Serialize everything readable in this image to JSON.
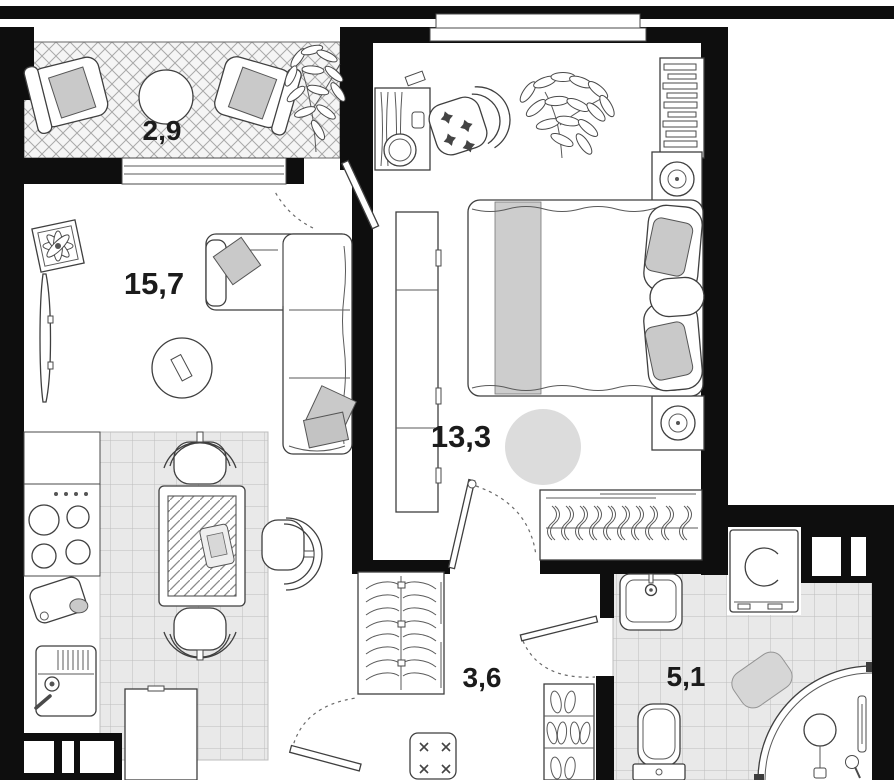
{
  "plan": {
    "title": "apartment-floor-plan",
    "rooms": [
      {
        "name": "balcony",
        "area": "2,9"
      },
      {
        "name": "living-room",
        "area": "15,7"
      },
      {
        "name": "bedroom",
        "area": "13,3"
      },
      {
        "name": "hallway",
        "area": "3,6"
      },
      {
        "name": "bathroom",
        "area": "5,1"
      }
    ],
    "colors": {
      "wall": "#0e0e0e",
      "floor": "#ffffff",
      "tile": "#e9e9e9",
      "tile_line": "#bdbdbd",
      "balcony_hatch": "#f5f5f5",
      "furniture_outline": "#3f3f3f",
      "soft_gray": "#c9c9c9",
      "rug_gray": "#dcdcdc",
      "label": "#1b1b1b"
    }
  }
}
